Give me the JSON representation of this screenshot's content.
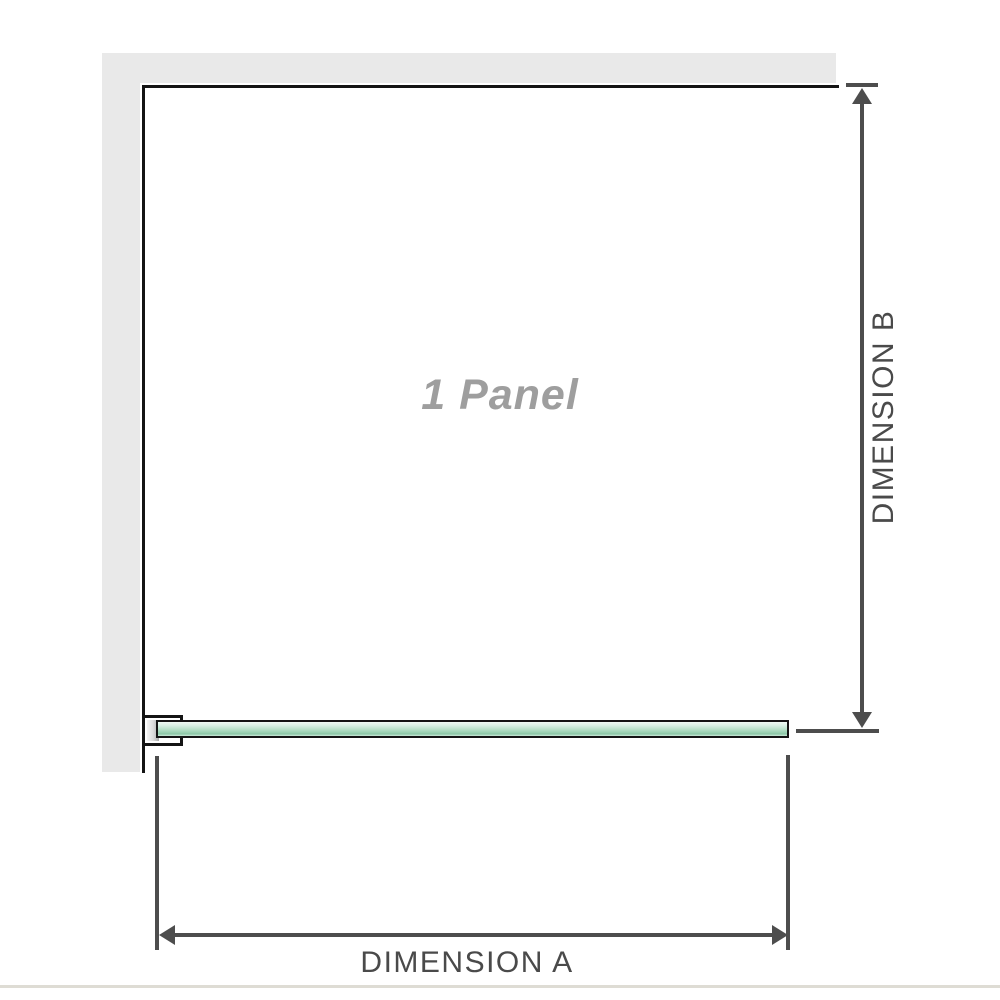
{
  "diagram": {
    "panel_label": "1 Panel",
    "dimension_a": {
      "label": "DIMENSION A"
    },
    "dimension_b": {
      "label": "DIMENSION B"
    },
    "colors": {
      "wall": "#e9e9e9",
      "panel_outline": "#141414",
      "glass_green_light": "#d9f0e4",
      "glass_green": "#a0d4b8",
      "glass_green_dark": "#8cc7a6",
      "dimension_line": "#4d4d4d",
      "dimension_text": "#4a4a4a",
      "panel_label_text": "#9e9e9e",
      "baseline": "#dedcd4"
    }
  }
}
